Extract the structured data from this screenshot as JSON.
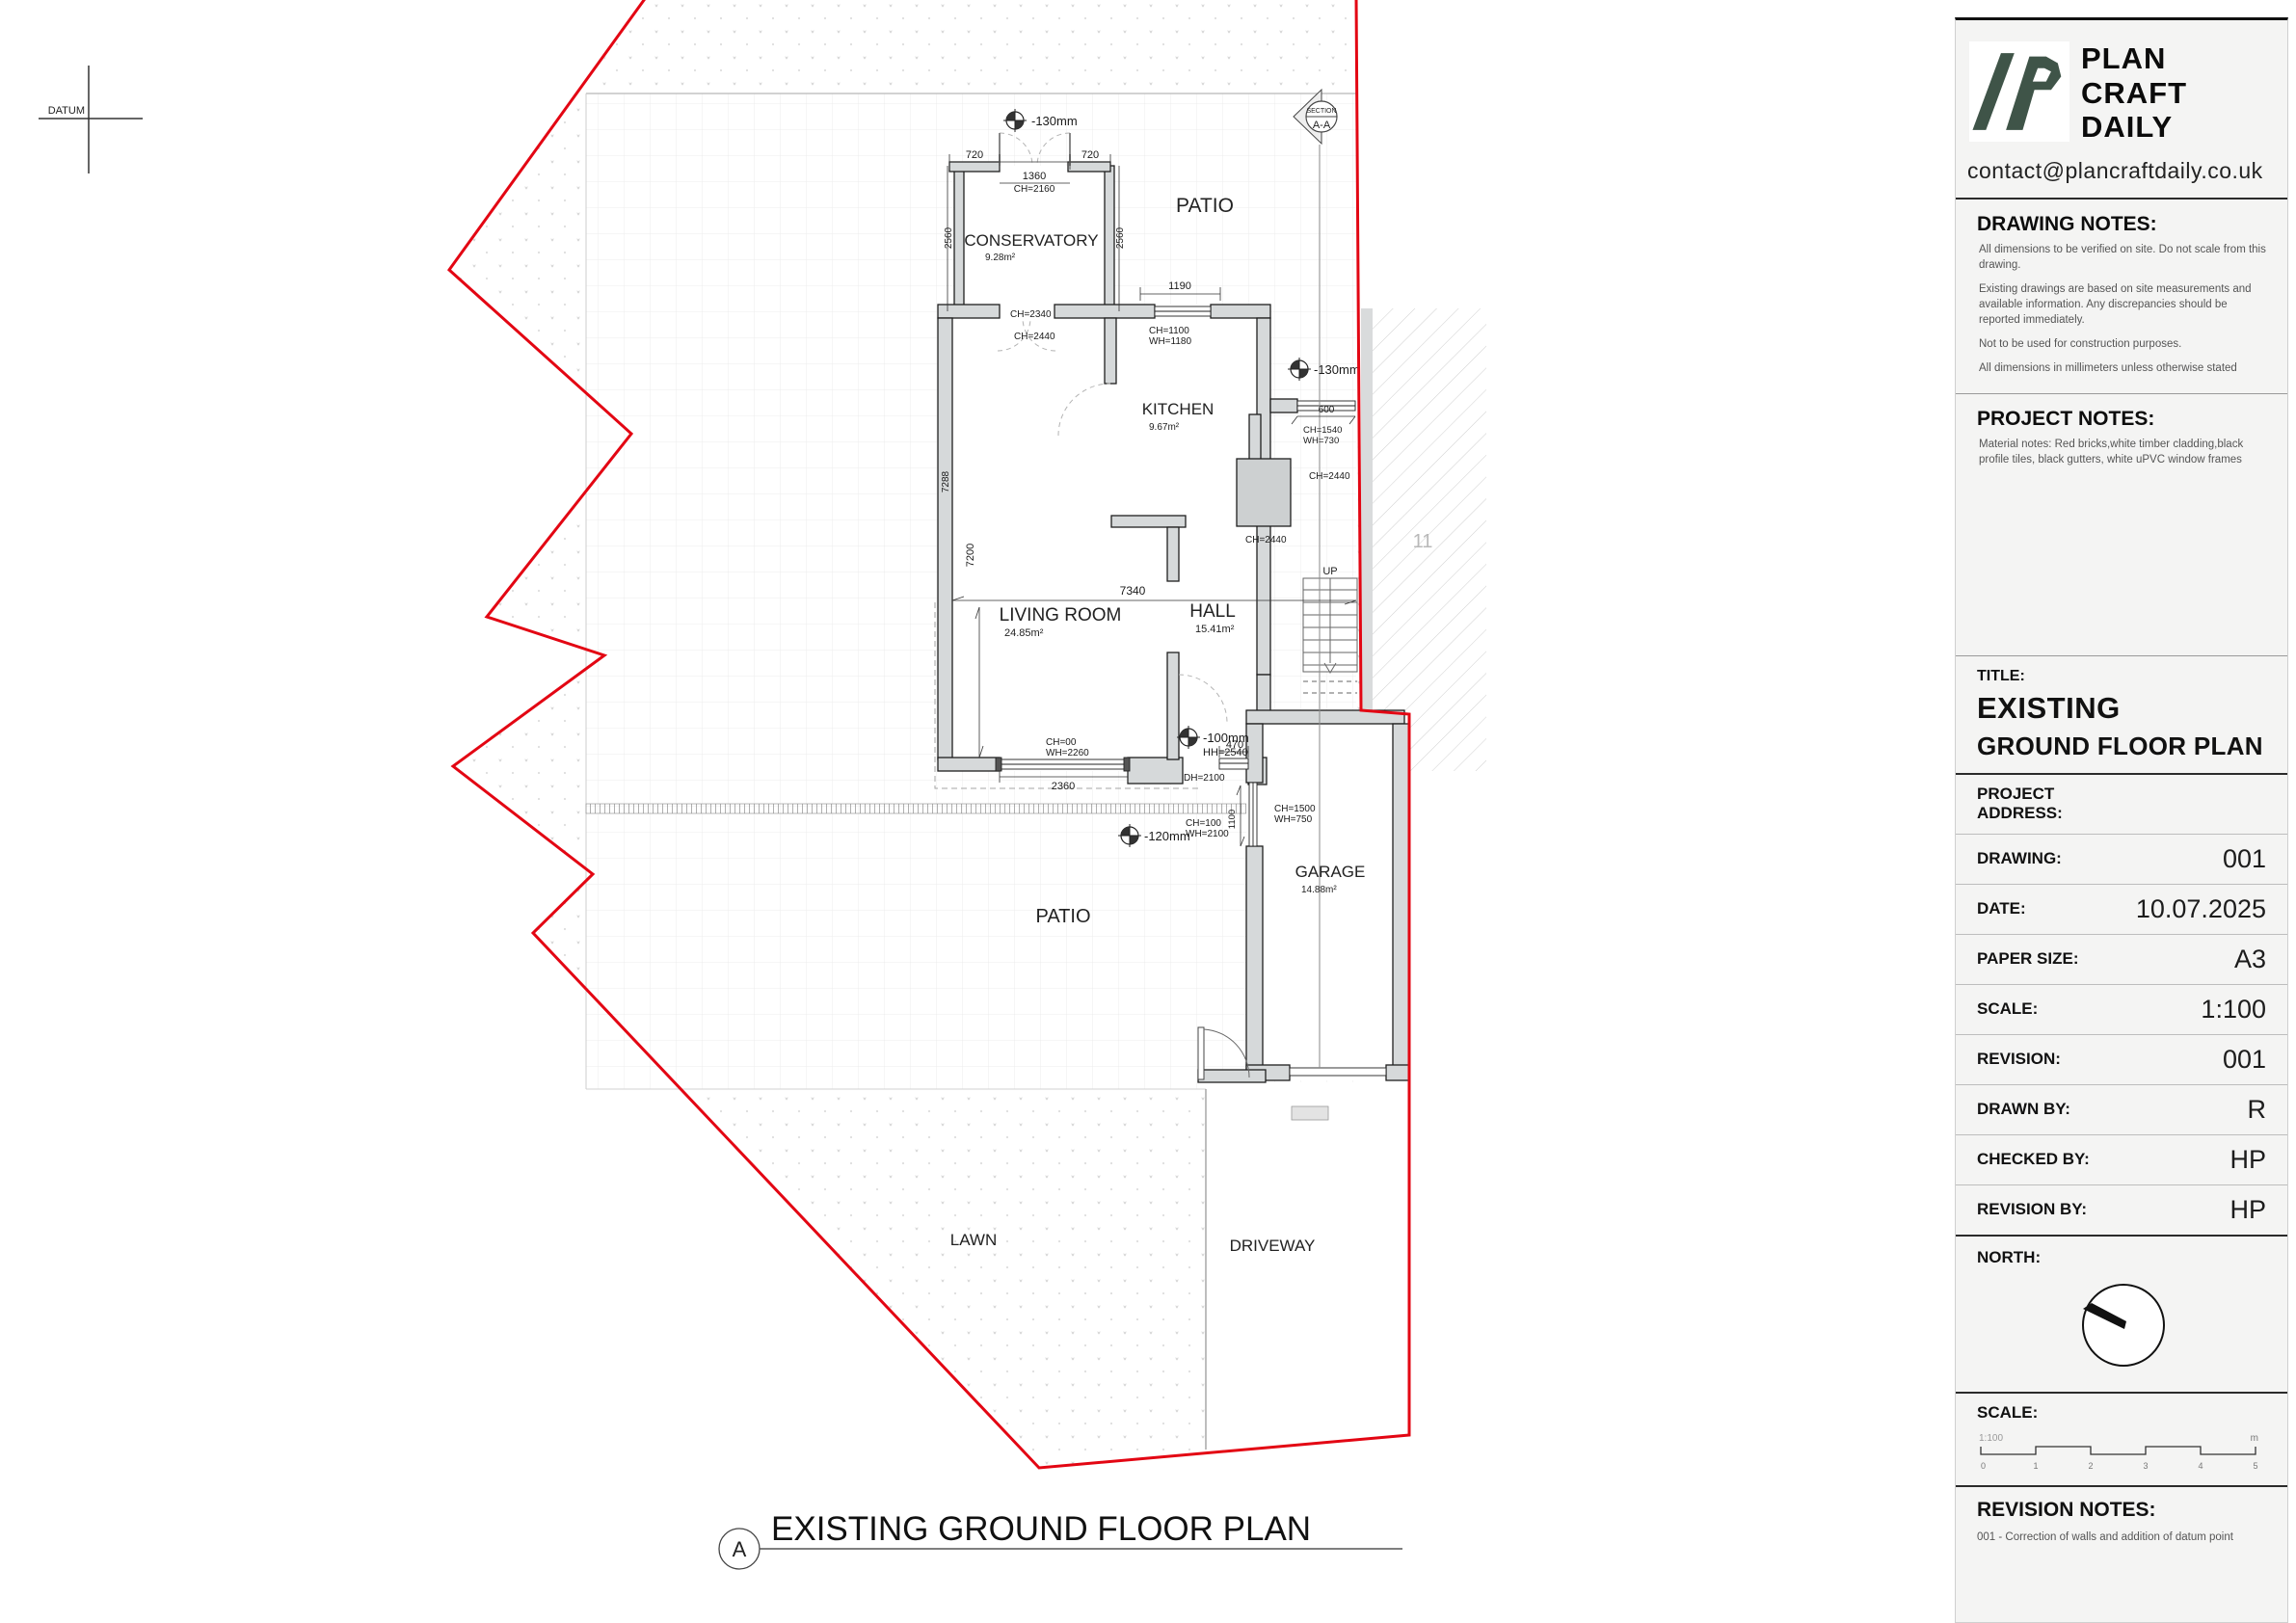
{
  "plan": {
    "datum_label": "DATUM",
    "section_marker": {
      "line1": "SECTION",
      "line2": "A-A"
    },
    "rooms": [
      {
        "name": "CONSERVATORY",
        "area": "9.28m²"
      },
      {
        "name": "KITCHEN",
        "area": "9.67m²"
      },
      {
        "name": "LIVING  ROOM",
        "area": "24.85m²"
      },
      {
        "name": "HALL",
        "area": "15.41m²"
      },
      {
        "name": "GARAGE",
        "area": "14.88m²"
      }
    ],
    "outdoor": {
      "patio_top": "PATIO",
      "patio_bottom": "PATIO",
      "lawn": "LAWN",
      "driveway": "DRIVEWAY"
    },
    "neighbor_plot": "11",
    "stairs_label": "UP",
    "levels": {
      "conservatory": "-130mm",
      "side": "-130mm",
      "hall": "-100mm",
      "patio": "-120mm"
    },
    "dims": {
      "cons_left": "720",
      "cons_opening": "1360",
      "cons_opening_ch": "CH=2160",
      "cons_right": "720",
      "cons_side_left": "2560",
      "cons_side_right": "2560",
      "cons_door_ch": "CH=2340",
      "cons_door_ch2": "CH=2440",
      "kitchen_win_w": "1190",
      "kitchen_win_ch": "CH=1100",
      "kitchen_win_wh": "WH=1180",
      "side_win_w": "600",
      "side_win_ch": "CH=1540",
      "side_win_wh": "WH=730",
      "side_ch": "CH=2440",
      "kitchen_ch": "CH=2440",
      "width_total": "7340",
      "height_total": "7200",
      "height_left": "7288",
      "hall_hh": "HH=2540",
      "lr_win_ch": "CH=00",
      "lr_win_wh": "WH=2260",
      "lr_win_w": "2360",
      "hall_win_w": "470",
      "hall_door_dh": "DH=2100",
      "front_door_ch": "CH=100",
      "front_door_wh": "WH=2100",
      "porch_side": "1100",
      "porch_win_ch": "CH=1500",
      "porch_win_wh": "WH=750"
    },
    "plan_title": {
      "bubble": "A",
      "text": "EXISTING GROUND FLOOR PLAN"
    }
  },
  "titleblock": {
    "brand": {
      "line1": "PLAN",
      "line2": "CRAFT",
      "line3": "DAILY",
      "email": "contact@plancraftdaily.co.uk"
    },
    "drawing_notes": {
      "heading": "DRAWING NOTES:",
      "items": [
        "All dimensions to be verified on site. Do not scale from this drawing.",
        "Existing drawings are based on site measurements and available information. Any discrepancies should be reported immediately.",
        "Not to be used for construction purposes.",
        "All dimensions in millimeters unless otherwise stated"
      ]
    },
    "project_notes": {
      "heading": "PROJECT NOTES:",
      "items": [
        "Material notes: Red bricks,white timber cladding,black profile tiles, black gutters, white uPVC window frames"
      ]
    },
    "title": {
      "label": "TITLE:",
      "line1": "EXISTING",
      "line2": "GROUND FLOOR PLAN"
    },
    "fields": [
      {
        "label": "PROJECT\nADDRESS:",
        "value": ""
      },
      {
        "label": "DRAWING:",
        "value": "001"
      },
      {
        "label": "DATE:",
        "value": "10.07.2025"
      },
      {
        "label": "PAPER SIZE:",
        "value": "A3"
      },
      {
        "label": "SCALE:",
        "value": "1:100"
      },
      {
        "label": "REVISION:",
        "value": "001"
      },
      {
        "label": "DRAWN BY:",
        "value": "R"
      },
      {
        "label": "CHECKED BY:",
        "value": "HP"
      },
      {
        "label": "REVISION BY:",
        "value": "HP"
      }
    ],
    "north_label": "NORTH:",
    "scale_section": {
      "label": "SCALE:",
      "ratio": "1:100",
      "unit": "m",
      "ticks": [
        "0",
        "1",
        "2",
        "3",
        "4",
        "5"
      ]
    },
    "revision_notes": {
      "heading": "REVISION NOTES:",
      "items": [
        "001 - Correction of walls and addition of datum point"
      ]
    }
  }
}
